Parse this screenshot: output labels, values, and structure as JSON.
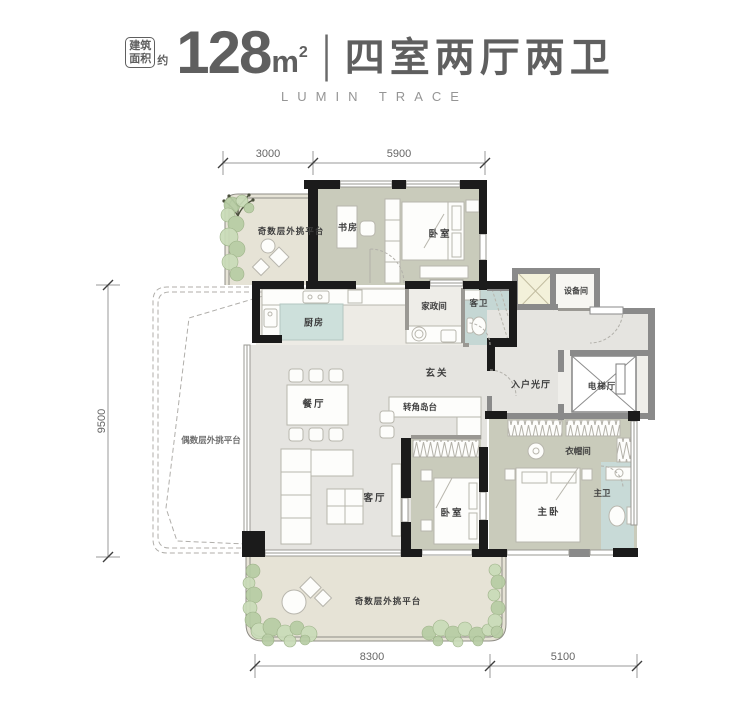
{
  "header": {
    "tag_line1": "建筑",
    "tag_line2": "面积",
    "approx": "约",
    "area_value": "128",
    "area_unit": "m",
    "area_exponent": "2",
    "divider": "|",
    "layout_title": "四室两厅两卫",
    "subtitle": "LUMIN TRACE"
  },
  "dimensions": {
    "top": [
      "3000",
      "5900"
    ],
    "left": [
      "9500"
    ],
    "bottom": [
      "8300",
      "5100"
    ]
  },
  "rooms": {
    "terrace_odd_top": "奇数层外挑平台",
    "study": "书房",
    "bedroom_top": "卧室",
    "kitchen": "厨房",
    "housekeeping": "家政间",
    "guest_bath": "客卫",
    "equipment": "设备间",
    "foyer": "玄关",
    "entry_hall": "入户光厅",
    "elevator_hall": "电梯厅",
    "dining": "餐厅",
    "corner_island": "转角岛台",
    "living": "客厅",
    "bedroom_second": "卧室",
    "closet": "衣帽间",
    "master_bedroom": "主卧",
    "master_bath": "主卫",
    "terrace_odd_bottom": "奇数层外挑平台",
    "terrace_even": "偶数层外挑平台"
  },
  "colors": {
    "wall_primary": "#1b1b1b",
    "wall_secondary": "#8a8a8a",
    "floor_bedroom": "#c9cbbb",
    "floor_hall": "#e5e4e0",
    "floor_terrace": "#e6e3d6",
    "bath": "#c5d7d4",
    "kitchen_island": "#cde0db",
    "shaft": "#f3f1da",
    "greenery": "#b7cda4",
    "accent_text": "#5f5f5f"
  }
}
